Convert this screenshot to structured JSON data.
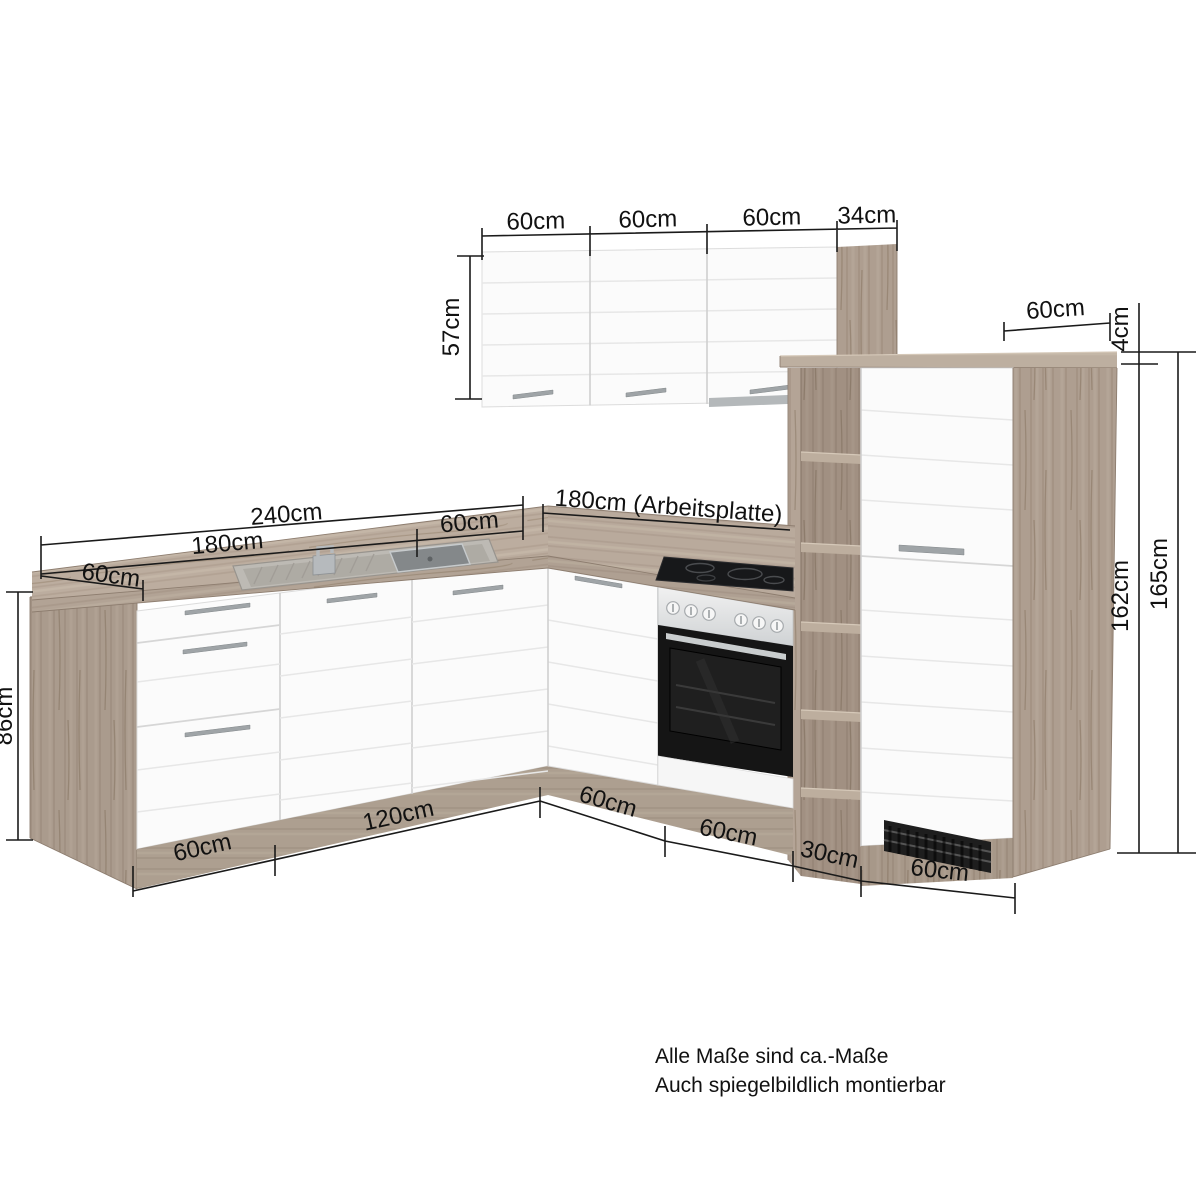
{
  "dimensions": {
    "wall_cabinets": {
      "widths": [
        "60cm",
        "60cm",
        "60cm",
        "34cm"
      ],
      "height": "57cm"
    },
    "tall_unit": {
      "top_depth": "60cm",
      "worktop_thickness": "4cm",
      "height_body": "162cm",
      "height_total": "165cm"
    },
    "countertop": {
      "total_length": "240cm",
      "left_section": "180cm",
      "right_section": "60cm",
      "depth": "60cm",
      "front_run": "180cm (Arbeitsplatte)"
    },
    "base_units": {
      "height": "86cm",
      "bottom_left": [
        "60cm",
        "120cm"
      ],
      "bottom_front": [
        "60cm",
        "60cm",
        "30cm",
        "60cm"
      ]
    }
  },
  "notes": [
    "Alle Maße sind ca.-Maße",
    "Auch spiegelbildlich montierbar"
  ],
  "colors": {
    "background": "#ffffff",
    "wood": "#b4a496",
    "wood_dark": "#9a8a7d",
    "wood_light": "#c7b8a8",
    "front_white": "#fbfbfb",
    "groove": "#e7e7e7",
    "dim_line": "#1a1a1a",
    "steel": "#c9cdce",
    "oven_black": "#151515"
  }
}
